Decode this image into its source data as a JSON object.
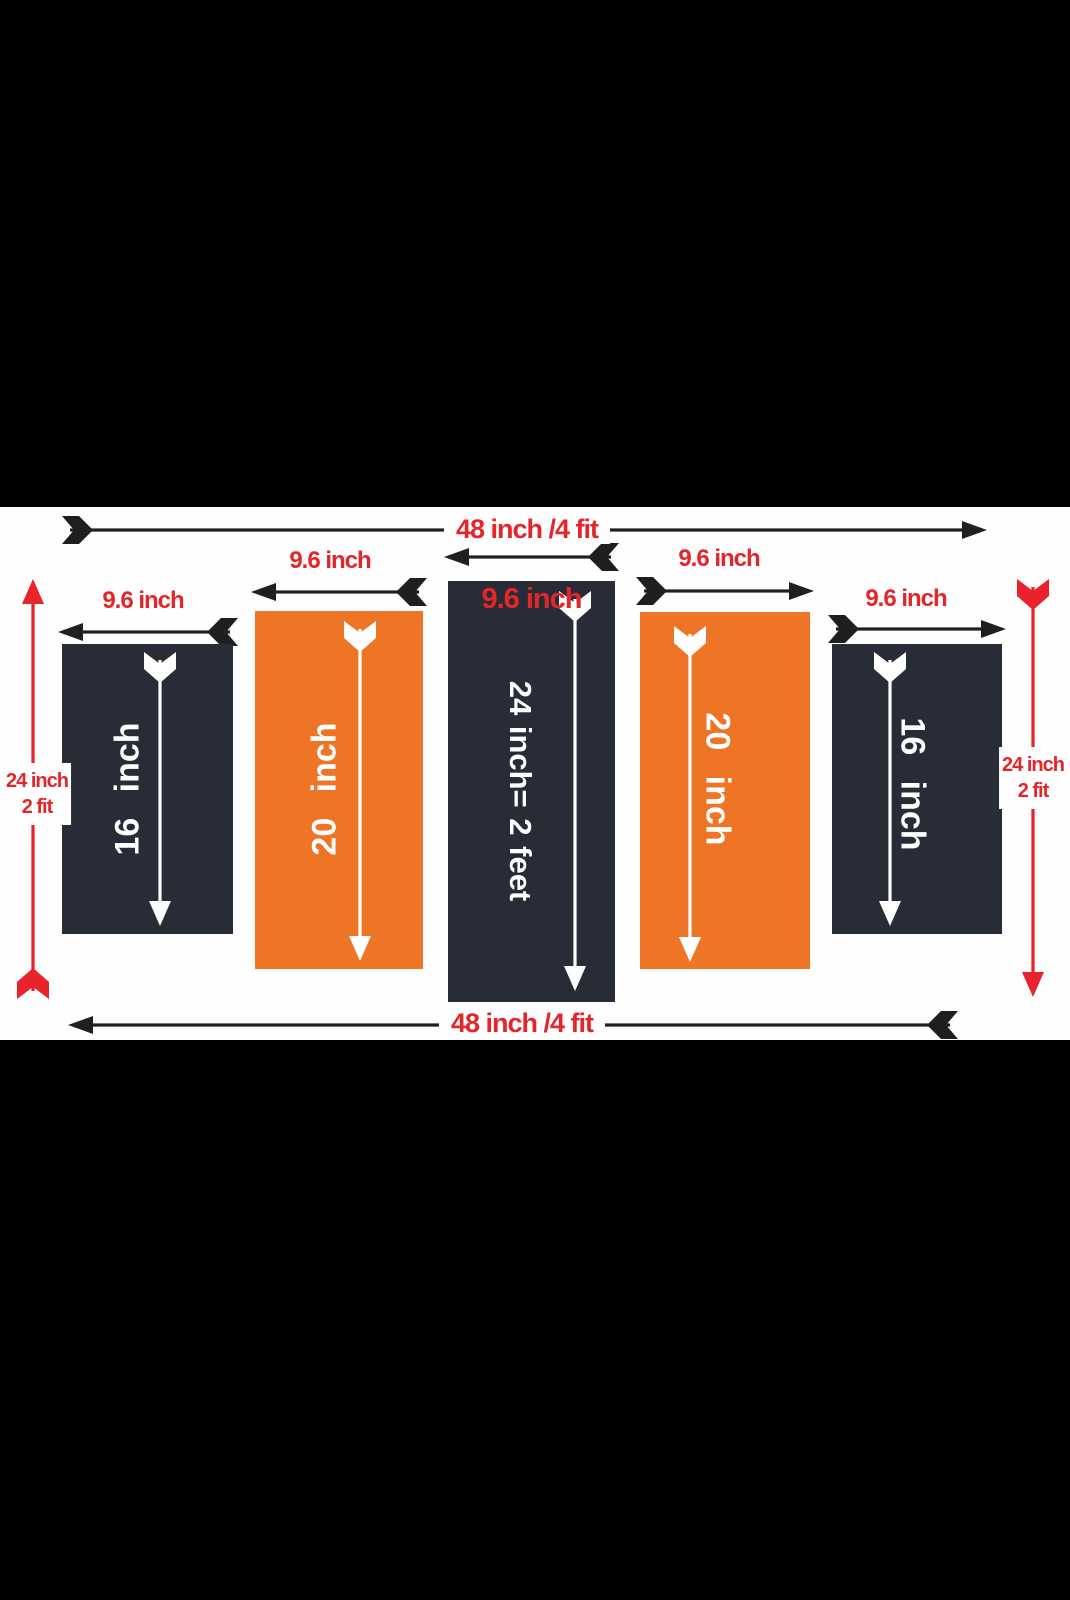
{
  "colors": {
    "letterbox": "#000000",
    "canvas": "#fefefe",
    "panel_dark": "#282c36",
    "panel_orange": "#ee7426",
    "label_red": "#e4252a",
    "arrow_red": "#e8232b",
    "arrow_black": "#1f1f1f",
    "arrow_white": "#ffffff"
  },
  "top_dimension": {
    "label": "48 inch /4 fit"
  },
  "bottom_dimension": {
    "label": "48 inch /4 fit"
  },
  "left_dimension": {
    "line1": "24 inch",
    "line2": "2 fit"
  },
  "right_dimension": {
    "line1": "24 inch",
    "line2": "2 fit"
  },
  "panels": [
    {
      "width_label": "9.6 inch",
      "length_label": "16 inch",
      "fill": "dark"
    },
    {
      "width_label": "9.6 inch",
      "length_label": "20 inch",
      "fill": "orange"
    },
    {
      "width_label": "9.6 inch",
      "length_label": "24 inch= 2 feet",
      "fill": "dark"
    },
    {
      "width_label": "9.6 inch",
      "length_label": "20 inch",
      "fill": "orange"
    },
    {
      "width_label": "9.6 inch",
      "length_label": "16 inch",
      "fill": "dark"
    }
  ]
}
